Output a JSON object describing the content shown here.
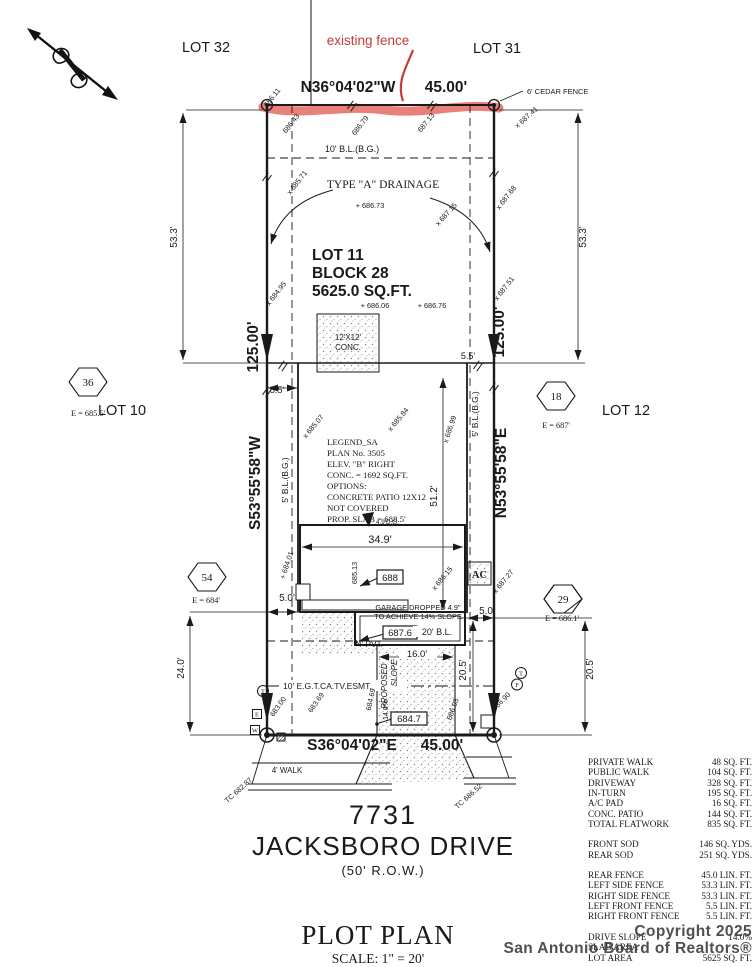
{
  "colors": {
    "line": "#1a1a1a",
    "annotation_red": "#c63b38",
    "fence_highlight": "#e2574e",
    "watermark": "#414141"
  },
  "site": {
    "lots": {
      "lot32": "LOT 32",
      "lot31": "LOT 31",
      "lot10": "LOT 10",
      "lot12": "LOT 12"
    },
    "subject": {
      "lot": "LOT 11",
      "block": "BLOCK 28",
      "area": "5625.0 SQ.FT."
    },
    "bearings": {
      "rear": "N36°04'02\"W",
      "rear_dist": "45.00'",
      "front": "S36°04'02\"E",
      "front_dist": "45.00'",
      "left": "S53°55'58\"W",
      "left_dist": "125.00'",
      "right": "N53°55'58\"E",
      "right_dist": "125.00'"
    },
    "fence_note": "existing fence",
    "cedar": "6' CEDAR FENCE",
    "drainage": "TYPE \"A\" DRAINAGE",
    "setbacks": {
      "rear": "10' B.L.(B.G.)",
      "left": "5' B.L.(B.G.)",
      "right": "5' B.L.(B.G.)",
      "front": "20' B.L.",
      "esmt": "10' E.G.T.CA.TV.ESMT."
    },
    "patio": {
      "l1": "12'X12'",
      "l2": "CONC."
    },
    "ac": "AC",
    "pvt": "4' PVT.",
    "walk": "4' WALK",
    "dg": "4.9'D.G.",
    "garage_note": {
      "l1": "GARAGE DROPPED 4.9\"",
      "l2": "TO ACHIEVE 14% SLOPE"
    },
    "slope_note": {
      "l1": "PROPOSED",
      "l2": "SLOPE",
      "l3": "14.0%"
    },
    "boxed": {
      "e688": "688",
      "e687_6": "687.6",
      "e684_7": "684.7"
    },
    "dims": {
      "d53l": "53.3'",
      "d53r": "53.3'",
      "d55l": "5.5'",
      "d55r": "5.5'",
      "d349": "34.9'",
      "d512": "51.2'",
      "d160": "16.0'",
      "d50l": "5.0'",
      "d50r": "5.0'",
      "d240": "24.0'",
      "d205i": "20.5'",
      "d205o": "20.5'"
    },
    "spots": [
      "686.11",
      "686.43",
      "686.79",
      "687.13",
      "x 687.41",
      "x 685.71",
      "+ 686.73",
      "x 687.15",
      "x 687.68",
      "x 684.95",
      "x 687.51",
      "+ 686.06",
      "+ 686.76",
      "x 685.07",
      "x 685.84",
      "x 686.99",
      "685.13",
      "x 686.15",
      "x 687.27",
      "+ 684.01",
      "683.00",
      "683.69",
      "684.69",
      "686.03",
      "686.90",
      "TC 682.87",
      "TC 686.52"
    ],
    "hex": {
      "h36": {
        "n": "36",
        "e": "E = 685.5'"
      },
      "h18": {
        "n": "18",
        "e": "E = 687'"
      },
      "h54": {
        "n": "54",
        "e": "E = 684'"
      },
      "h29": {
        "n": "29",
        "e": "E = 686.1'"
      }
    },
    "utils": {
      "t1": "T",
      "e": "E",
      "w": "W",
      "t2": "T",
      "f": "F"
    }
  },
  "legend": {
    "l1": "LEGEND_SA",
    "l2": "PLAN No. 3505",
    "l3": "ELEV. \"B\" RIGHT",
    "l4": "CONC. = 1692 SQ.FT.",
    "l5": "OPTIONS:",
    "l6": "CONCRETE PATIO 12X12",
    "l7": "NOT COVERED",
    "l8": "PROP. SLAB = 688.5'"
  },
  "table": {
    "flatwork": [
      {
        "label": "PRIVATE WALK",
        "value": "48 SQ. FT."
      },
      {
        "label": "PUBLIC WALK",
        "value": "104 SQ. FT."
      },
      {
        "label": "DRIVEWAY",
        "value": "328 SQ. FT."
      },
      {
        "label": "IN-TURN",
        "value": "195 SQ. FT."
      },
      {
        "label": "A/C PAD",
        "value": "16 SQ. FT."
      },
      {
        "label": "CONC. PATIO",
        "value": "144 SQ. FT."
      },
      {
        "label": "TOTAL FLATWORK",
        "value": "835 SQ. FT."
      }
    ],
    "sod": [
      {
        "label": "FRONT SOD",
        "value": "146 SQ. YDS."
      },
      {
        "label": "REAR SOD",
        "value": "251 SQ. YDS."
      }
    ],
    "fence": [
      {
        "label": "REAR FENCE",
        "value": "45.0 LIN. FT."
      },
      {
        "label": "LEFT SIDE FENCE",
        "value": "53.3 LIN. FT."
      },
      {
        "label": "RIGHT SIDE FENCE",
        "value": "53.3 LIN. FT."
      },
      {
        "label": "LEFT FRONT FENCE",
        "value": "5.5 LIN. FT."
      },
      {
        "label": "RIGHT FRONT FENCE",
        "value": "5.5 LIN. FT."
      }
    ],
    "misc": [
      {
        "label": "DRIVE SLOPE",
        "value": "14.0%"
      },
      {
        "label": "SLAB AREA",
        "value": ""
      },
      {
        "label": "LOT AREA",
        "value": "5625 SQ. FT."
      }
    ]
  },
  "street": {
    "number": "7731",
    "name": "JACKSBORO DRIVE",
    "row": "(50' R.O.W.)"
  },
  "titleblock": {
    "title": "PLOT PLAN",
    "scale": "SCALE: 1\" = 20'"
  },
  "watermark": {
    "line1": "Copyright 2025",
    "line2": "San Antonio Board of Realtors®"
  }
}
